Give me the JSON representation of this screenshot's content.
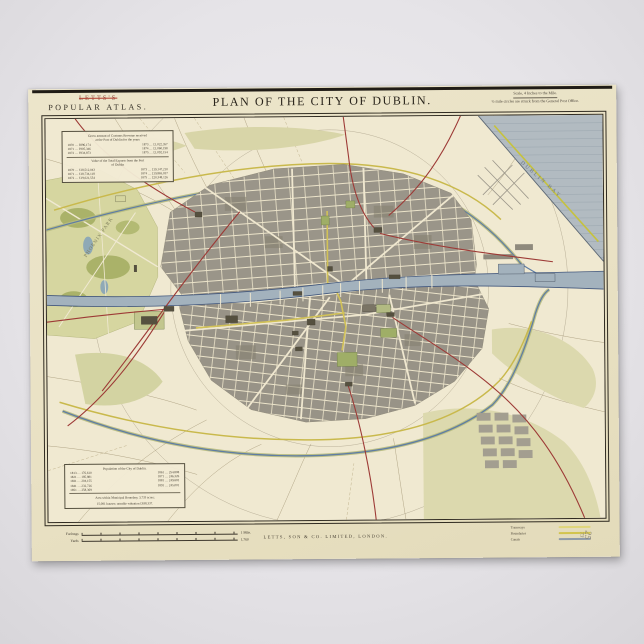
{
  "header": {
    "publisher_line1": "LETTS'S",
    "publisher_line2": "POPULAR ATLAS.",
    "title": "PLAN OF THE CITY OF DUBLIN.",
    "scale_note": "Scale, 4 Inches to the Mile.",
    "circles_note": "½ mile circles are struck from the General Post Office."
  },
  "customs_box": {
    "heading_a1": "Gross amount of Customs Revenue received",
    "heading_a2": "at the Port of Dublin for the years",
    "rows_a": [
      [
        "1870 … £896,174",
        "1873 … £1,022,357"
      ],
      [
        "1871 … £905,346",
        "1874 … £1,060,198"
      ],
      [
        "1872 … £934,873",
        "1875 … £1,092,154"
      ]
    ],
    "heading_b1": "Value of the Total Exports from the Port",
    "heading_b2": "of Dublin",
    "rows_b": [
      [
        "1870 … £18,512,043",
        "1873 … £19,147,210"
      ],
      [
        "1871 … £18,734,118",
        "1874 … £19,865,037"
      ],
      [
        "1872 … £19,021,554",
        "1875 … £20,348,126"
      ]
    ]
  },
  "population_box": {
    "heading": "Population of the City of Dublin.",
    "rows": [
      [
        "1813 … 176,610",
        "1861 … 254,808"
      ],
      [
        "1821 … 185,881",
        "1871 … 246,326"
      ],
      [
        "1831 … 204,155",
        "1881 … 249,602"
      ],
      [
        "1841 … 232,726",
        "1891 … 245,001"
      ],
      [
        "1851 … 258,369",
        ""
      ]
    ],
    "note1": "Area within Municipal Boundary, 3,733 acres;",
    "note2": "15,081 houses; rateable valuation £638,337."
  },
  "map_labels": {
    "phoenix_park": "PHOENIX PARK",
    "dublin_bay": "DUBLIN BAY"
  },
  "footer": {
    "imprint": "LETTS, SON & CO. LIMITED, LONDON.",
    "scalebar1_label": "Furlongs",
    "scalebar1_end": "1 Mile.",
    "scalebar2_label": "Yards",
    "scalebar2_end": "1,760",
    "key": [
      {
        "label": "Tramways",
        "color": "#e0d67a"
      },
      {
        "label": "Boundaries",
        "color": "#d2c44e"
      },
      {
        "label": "Canals",
        "color": "#8e9aa8"
      }
    ],
    "pencil_mark_1": "25",
    "pencil_mark_2": "73"
  },
  "colors": {
    "paper": "#ebe3c6",
    "river": "#a3b2bd",
    "bay": "#b2bbc1",
    "park": "#d6d6a0",
    "city_blocks": "#9a9589",
    "railway_red": "#9d3a36",
    "road_yellow": "#cdbd4e",
    "canal_blue": "#5f7da4",
    "frame_ink": "#302b21"
  }
}
